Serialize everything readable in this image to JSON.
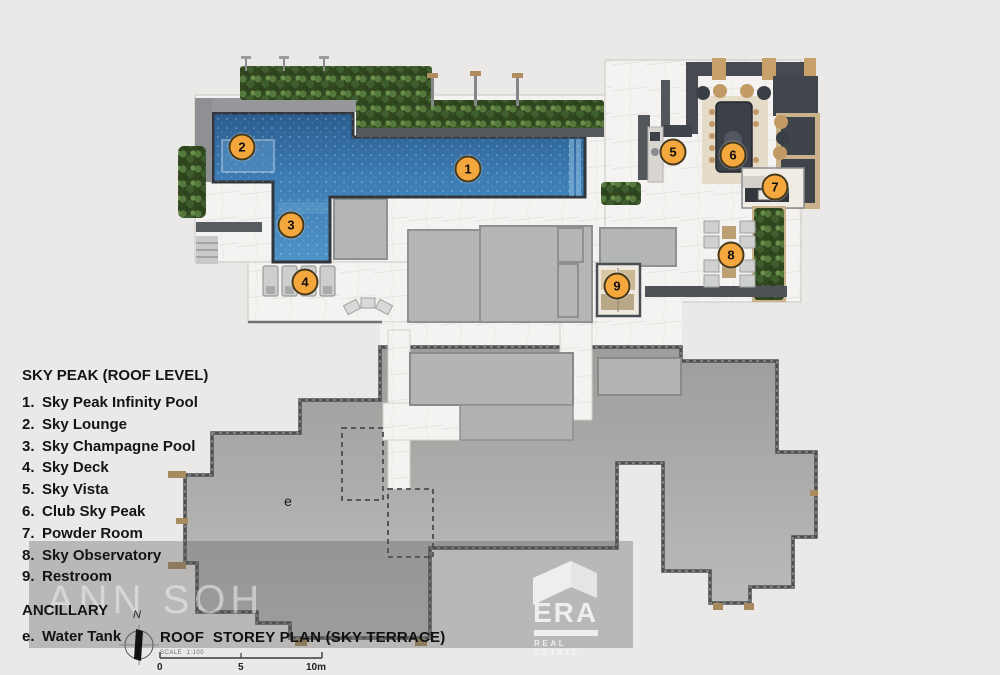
{
  "legend": {
    "title": "SKY PEAK (ROOF LEVEL)",
    "items": [
      {
        "num": "1.",
        "label": "Sky Peak Infinity Pool"
      },
      {
        "num": "2.",
        "label": "Sky Lounge"
      },
      {
        "num": "3.",
        "label": "Sky Champagne Pool"
      },
      {
        "num": "4.",
        "label": "Sky Deck"
      },
      {
        "num": "5.",
        "label": "Sky Vista"
      },
      {
        "num": "6.",
        "label": "Club Sky Peak"
      },
      {
        "num": "7.",
        "label": "Powder Room"
      },
      {
        "num": "8.",
        "label": "Sky Observatory"
      },
      {
        "num": "9.",
        "label": "Restroom"
      }
    ],
    "ancillary_title": "ANCILLARY",
    "ancillary_items": [
      {
        "num": "e.",
        "label": "Water Tank"
      }
    ]
  },
  "plan": {
    "markers": [
      {
        "label": "1"
      },
      {
        "label": "2"
      },
      {
        "label": "3"
      },
      {
        "label": "4"
      },
      {
        "label": "5"
      },
      {
        "label": "6"
      },
      {
        "label": "7"
      },
      {
        "label": "8"
      },
      {
        "label": "9"
      }
    ],
    "unit_label": "e"
  },
  "watermark": {
    "name": "ANN SOH"
  },
  "brand": {
    "name": "ERA",
    "tagline": "REAL ESTATE"
  },
  "footer": {
    "north_label": "N",
    "plan_title": "ROOF  STOREY PLAN (SKY TERRACE)",
    "scale_note": "SCALE  1:100",
    "scale_ticks": [
      "0",
      "5",
      "10m"
    ]
  },
  "colors": {
    "pool_blue": "#3d7cb5",
    "marker_orange": "#f3a73c",
    "greenery": "#55793d",
    "roof_gray": "#a8aaa8"
  }
}
